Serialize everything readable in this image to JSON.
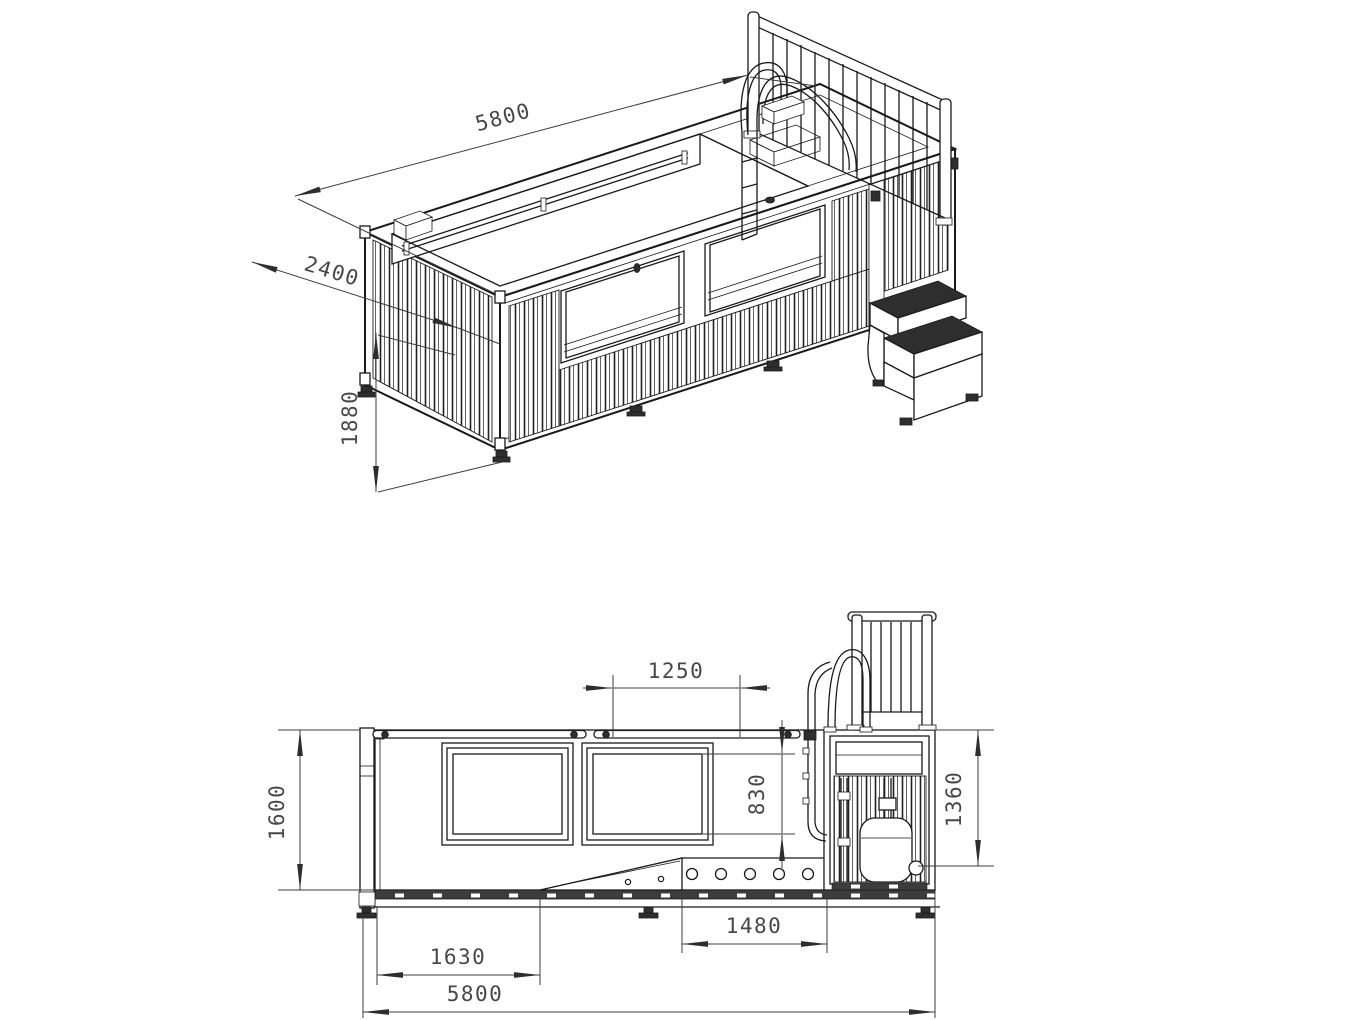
{
  "drawing": {
    "type": "engineering drawing",
    "subject": "shipping container swimming pool with safety railing, pool ladder, entry steps and equipment bay",
    "colors": {
      "background": "#ffffff",
      "line": "#1a1a1a",
      "dimension_line": "#3c3c3c",
      "label_text": "#474747",
      "dark_fill": "#2e2e2e"
    },
    "views": {
      "isometric": {
        "label": "isometric view",
        "dims": {
          "length": "5800",
          "width": "2400",
          "height": "1880"
        }
      },
      "side": {
        "label": "side elevation",
        "dims": {
          "window_width": "1250",
          "window_height": "830",
          "height_left": "1600",
          "height_right": "1360",
          "section_left": "1630",
          "section_holes": "1480",
          "overall_length": "5800"
        }
      }
    }
  }
}
